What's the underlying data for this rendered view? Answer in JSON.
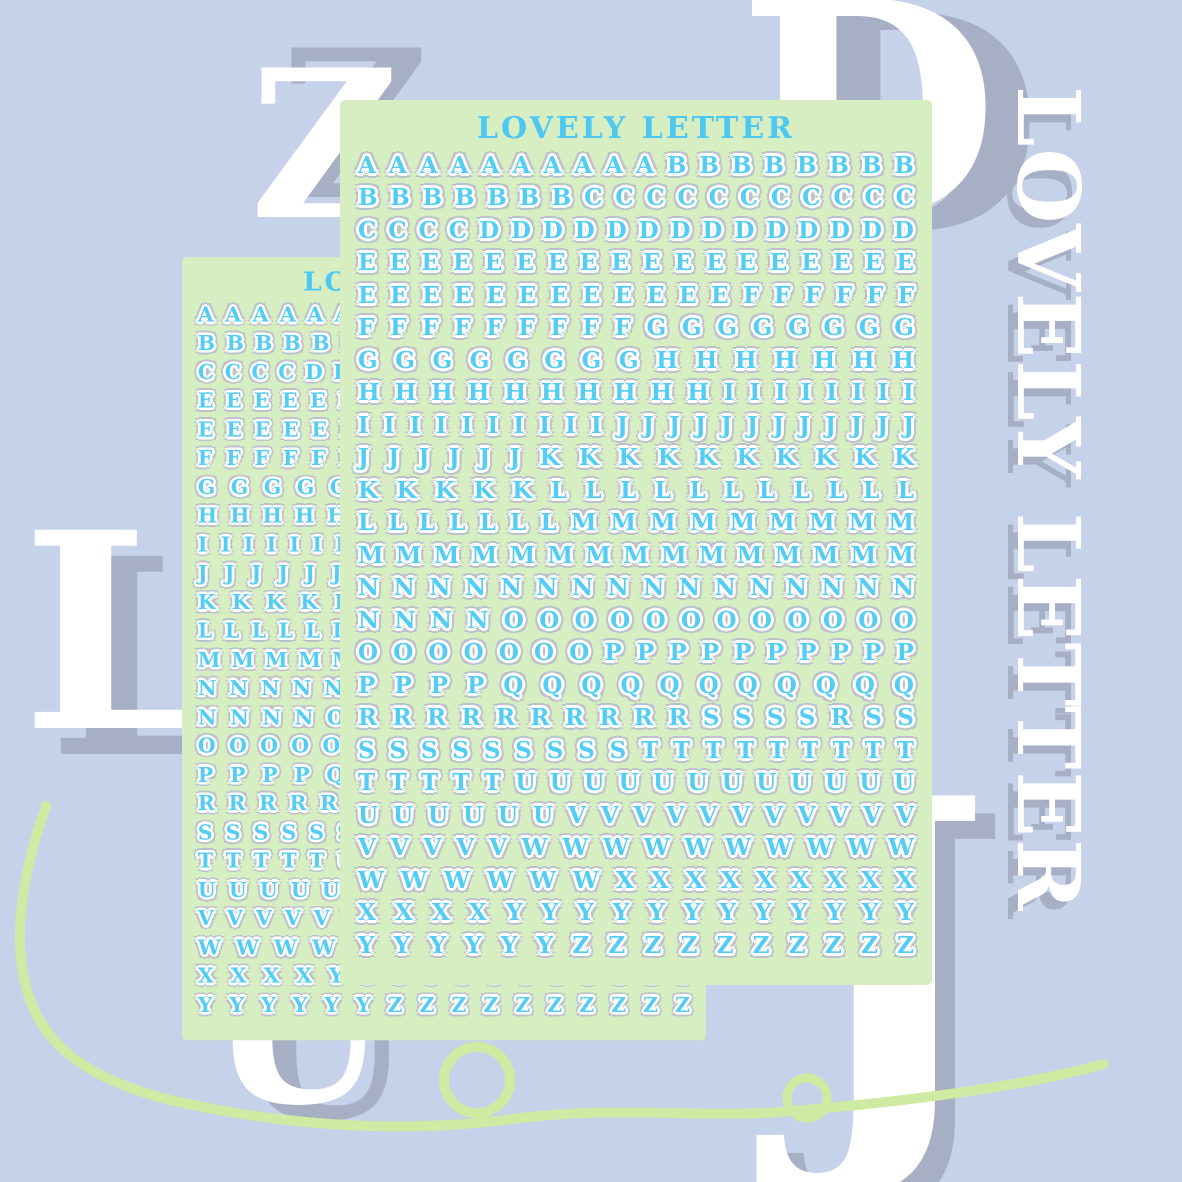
{
  "brand": {
    "vertical_text": "LOVELY LETTER"
  },
  "decor": {
    "big_letters": [
      {
        "char": "Z"
      },
      {
        "char": "D"
      },
      {
        "char": "L"
      },
      {
        "char": "J"
      },
      {
        "char": "U"
      }
    ]
  },
  "sheets": {
    "front": {
      "title": "LOVELY LETTER"
    },
    "back": {
      "title": "LOVELY LETTER"
    }
  },
  "sheet_rows": [
    "AAAAAAAAAABBBBBBBB",
    "BBBBBBBCCCCCCCCCCC",
    "CCCCDDDDDDDDDDDDDD",
    "EEEEEEEEEEEEEEEEEE",
    "EEEEEEEEEEEEFFFFFF",
    "FFFFFFFFFGGGGGGGG",
    "GGGGGGGGHHHHHHH",
    "HHHHHHHHHHIIIIIIII",
    "IIIIIIIIIIJJJJJJJJJJJJ",
    "JJJJJJKKKKKKKKKK",
    "KKKKKLLLLLLLLLLL",
    "LLLLLLLMMMMMMMMM",
    "MMMMMMMMMMMMMMM",
    "NNNNNNNNNNNNNNNN",
    "NNNNOOOOOOOOOOOO",
    "OOOOOOOPPPPPPPPPP",
    "PPPPQQQQQQQQQQQ",
    "RRRRRRRRRRSSSSRSS",
    "SSSSSSSSSTTTTTTTTT",
    "TTTTTUUUUUUUUUUUU",
    "UUUUUUVVVVVVVVVVV",
    "VVVVVWWWWWWWWWW",
    "WWWWWWXXXXXXXXX",
    "XXXXYYYYYYYYYYYY",
    "YYYYYYZZZZZZZZZZ"
  ],
  "colors": {
    "background": "#c6d1ea",
    "sheet_green": "#d6eec2",
    "letter_blue": "#54cdf4",
    "sticker_outline_gray": "#bcc1cb",
    "shadow_gray": "#a6afc4",
    "squiggle_green": "#cfeaa2",
    "white": "#ffffff"
  }
}
